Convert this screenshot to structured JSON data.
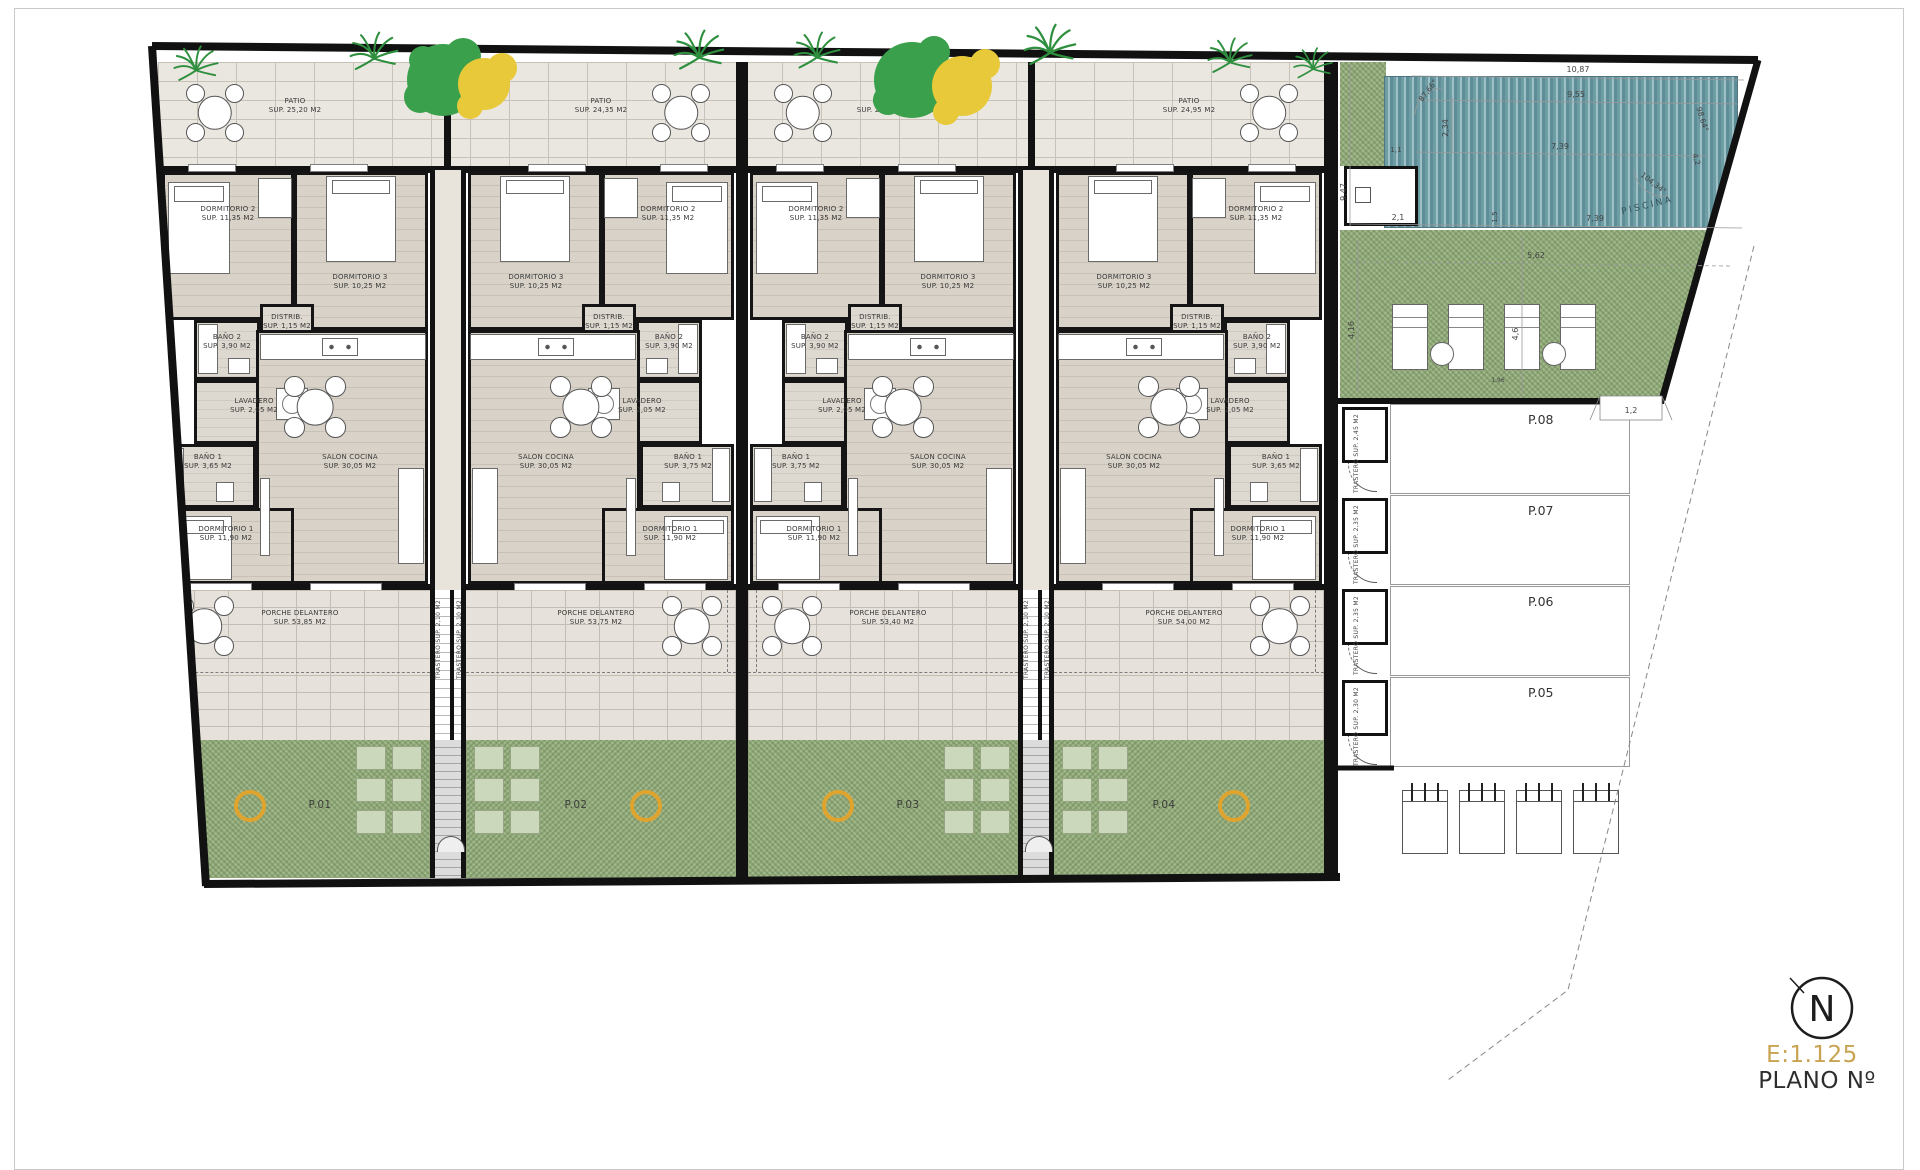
{
  "sheet": {
    "north": "N",
    "scale": "E:1.125",
    "plano": "PLANO Nº"
  },
  "rooms": {
    "patio": "PATIO",
    "dormitorio1": "DORMITORIO 1",
    "dormitorio1_sup": "SUP. 11,90 M2",
    "dormitorio2": "DORMITORIO 2",
    "dormitorio2_sup": "SUP. 11,35 M2",
    "dormitorio3": "DORMITORIO 3",
    "dormitorio3_sup": "SUP. 10,25 M2",
    "bano2": "BAÑO 2",
    "bano2_sup": "SUP. 3,90 M2",
    "bano1": "BAÑO 1",
    "distrib": "DISTRIB.",
    "distrib_sup": "SUP. 1,15 M2",
    "lavadero": "LAVADERO",
    "lavadero_sup": "SUP. 2,05 M2",
    "salon": "SALON COCINA",
    "salon_sup": "SUP. 30,05 M2",
    "porche": "PORCHE DELANTERO"
  },
  "units": [
    {
      "plot": "P.01",
      "patio_sup": "SUP. 25,20 M2",
      "porche_sup": "SUP. 53,85 M2",
      "bano1_sup": "SUP. 3,65 M2"
    },
    {
      "plot": "P.02",
      "patio_sup": "SUP. 24,35 M2",
      "porche_sup": "SUP. 53,75 M2",
      "bano1_sup": "SUP. 3,75 M2"
    },
    {
      "plot": "P.03",
      "patio_sup": "SUP. 26,00 M2",
      "porche_sup": "SUP. 53,40 M2",
      "bano1_sup": "SUP. 3,75 M2"
    },
    {
      "plot": "P.04",
      "patio_sup": "SUP. 24,95 M2",
      "porche_sup": "SUP. 54,00 M2",
      "bano1_sup": "SUP. 3,65 M2"
    }
  ],
  "stairwell": {
    "trastero": "TRASTERO",
    "trastero_sup": "SUP. 2,10 M2"
  },
  "parking": {
    "trastero": "TRASTERO",
    "rows": [
      {
        "id": "P.08",
        "trastero_sup": "SUP. 2,45 M2"
      },
      {
        "id": "P.07",
        "trastero_sup": "SUP. 2,35 M2"
      },
      {
        "id": "P.06",
        "trastero_sup": "SUP. 2,35 M2"
      },
      {
        "id": "P.05",
        "trastero_sup": "SUP. 2,30 M2"
      }
    ]
  },
  "pool": {
    "label": "PISCINA",
    "dims": {
      "top": "10,87",
      "upper": "9,55",
      "mid": "7,39",
      "left_height": "9,47",
      "inner_v": "2,34",
      "small": "1,1",
      "deck_left": "2,1",
      "deck_gap": "1,5",
      "bottom": "7,39",
      "angle_top_left": "87,66°",
      "angle_right": "98,64°",
      "edge_right": "4,2",
      "angle_bottom_right": "104,34°",
      "lawn_left": "4,16",
      "lawn_mid": "4,6",
      "lawn_width": "5,62",
      "lawn_small": "1,96",
      "gate_width": "1,2"
    }
  },
  "colors": {
    "grass": "#a3ba8c",
    "pool_teal": "#6f9da6",
    "accent_gold": "#c8a352",
    "tree_green": "#3aa04c",
    "tree_yellow": "#e8c93a",
    "ring_orange": "#e0a42e"
  }
}
